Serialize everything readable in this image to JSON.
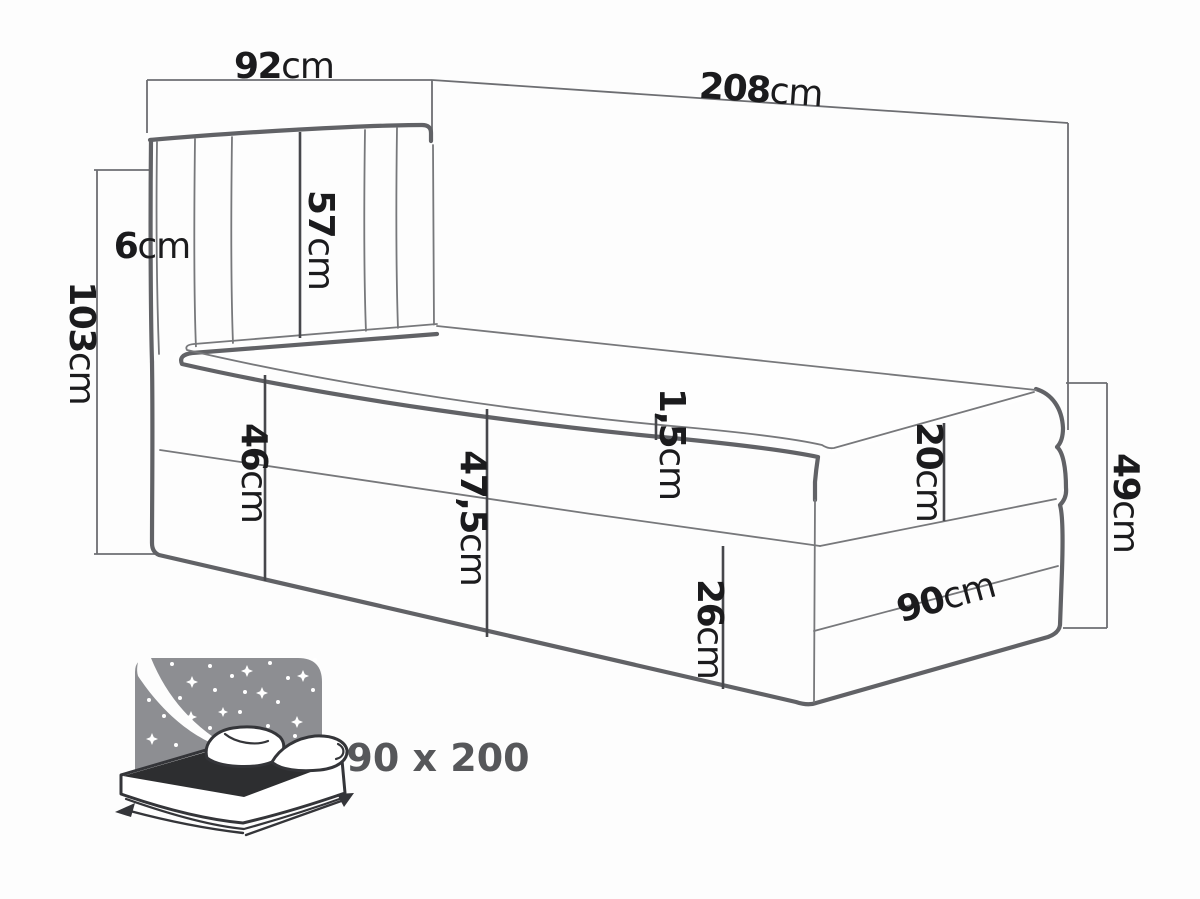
{
  "dims": {
    "headboard_width": {
      "value": "92",
      "unit": "cm"
    },
    "bed_length": {
      "value": "208",
      "unit": "cm"
    },
    "total_height": {
      "value": "103",
      "unit": "cm"
    },
    "headboard_side_depth": {
      "value": "6",
      "unit": "cm"
    },
    "headboard_panel_height": {
      "value": "57",
      "unit": "cm"
    },
    "base_height_head": {
      "value": "46",
      "unit": "cm"
    },
    "side_height_mid": {
      "value": "47,5",
      "unit": "cm"
    },
    "topper_edge": {
      "value": "1,5",
      "unit": "cm"
    },
    "mattress_thickness": {
      "value": "20",
      "unit": "cm"
    },
    "lower_box_height": {
      "value": "26",
      "unit": "cm"
    },
    "foot_end_height": {
      "value": "49",
      "unit": "cm"
    },
    "bed_width": {
      "value": "90",
      "unit": "cm"
    }
  },
  "icon": {
    "size_label": "90 x 200"
  },
  "colors": {
    "line_thick": "#616266",
    "line_thin": "#77787b",
    "dimension": "#6d6e72",
    "annotation": "#46474b",
    "text": "#1b1b1d",
    "icon_gray": "#8d8e92",
    "icon_dark": "#2d2e30",
    "icon_outline": "#343539",
    "icon_text": "#56575a",
    "background": "#fdfdfd"
  }
}
